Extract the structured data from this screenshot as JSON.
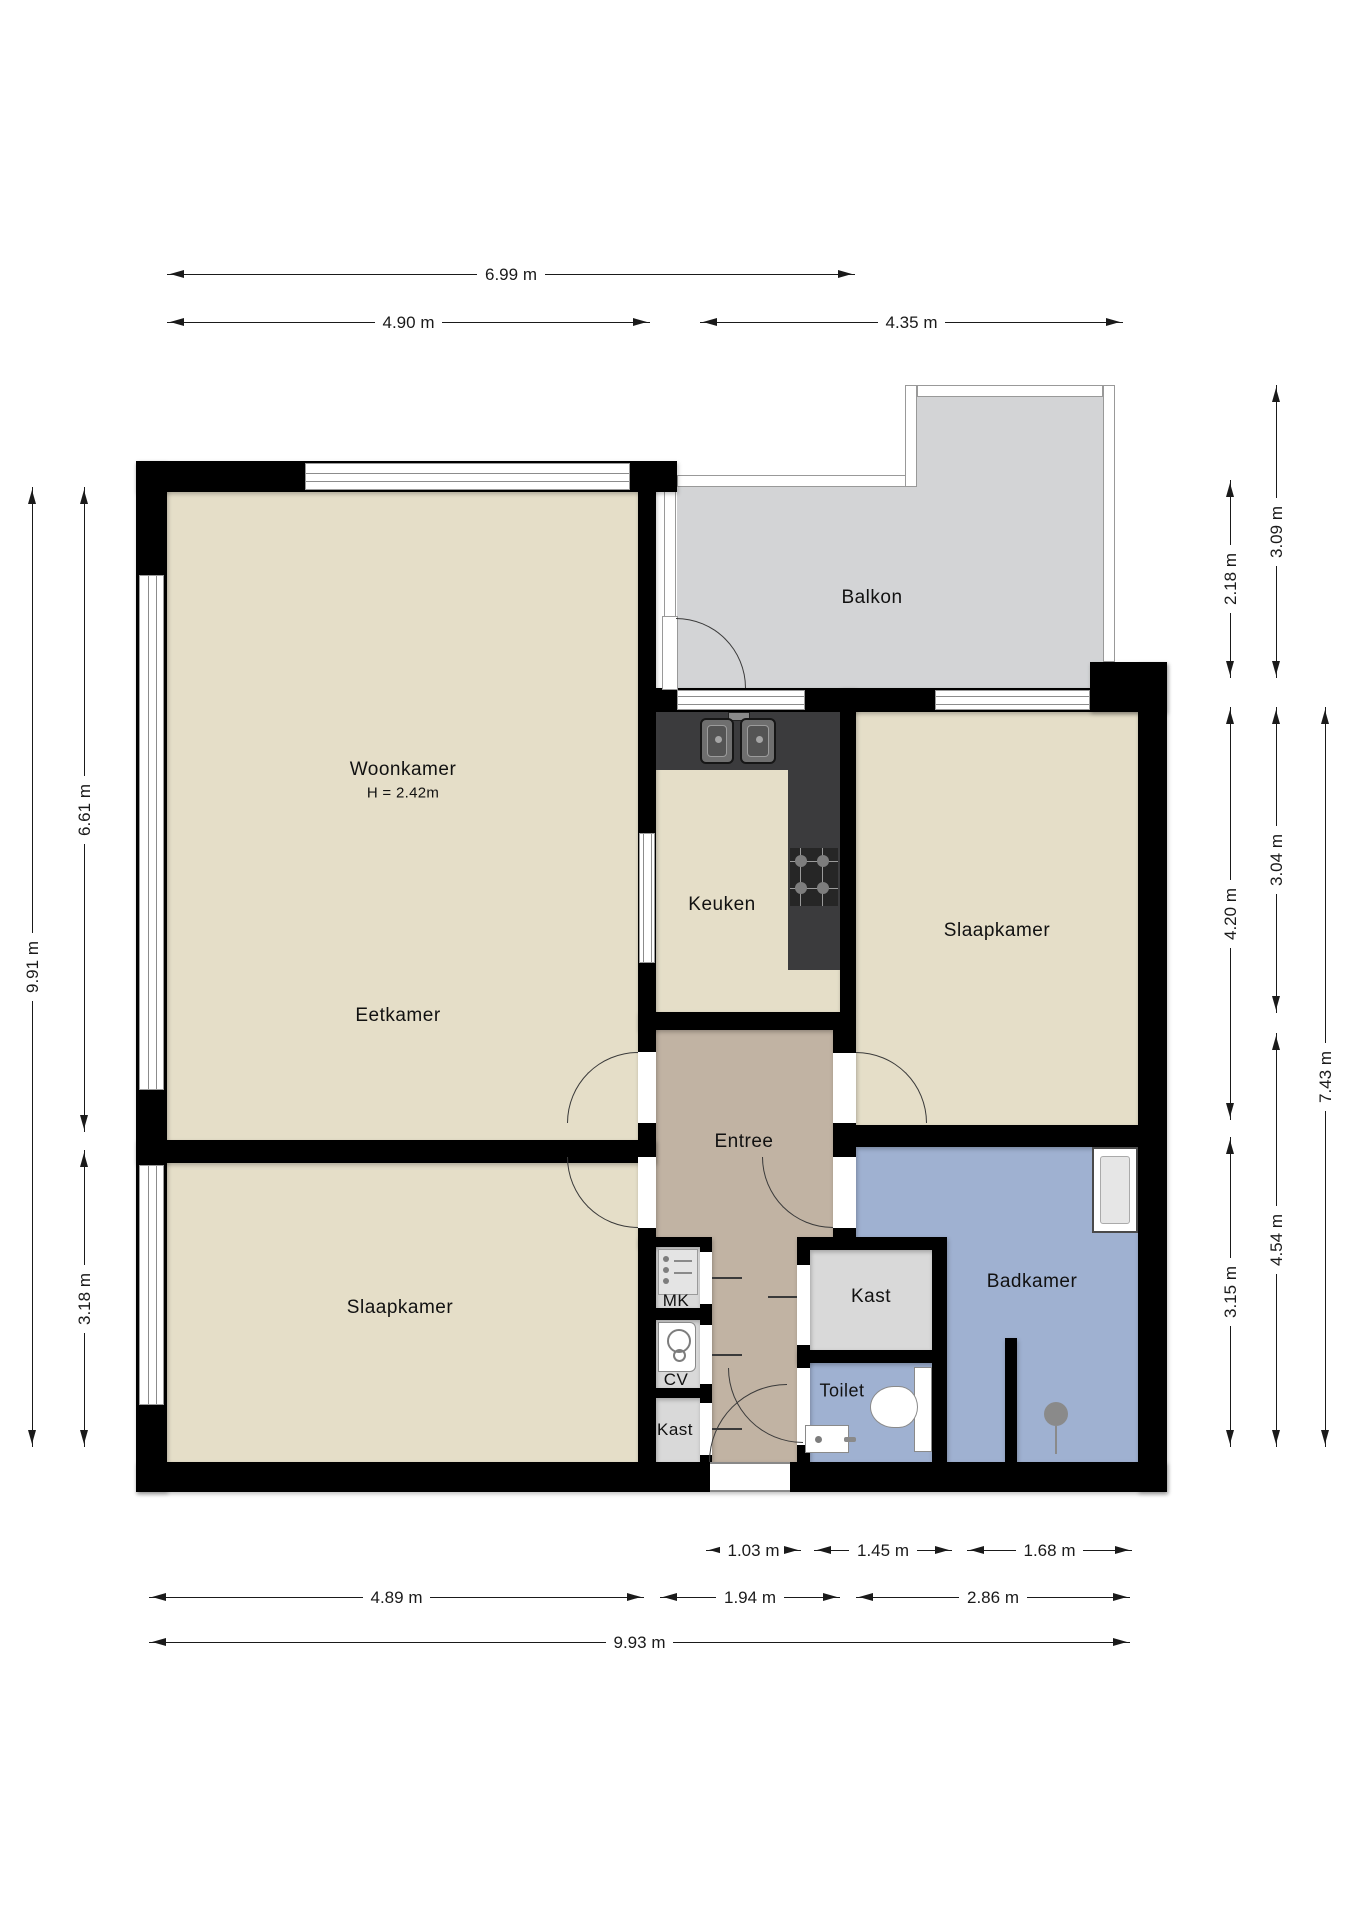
{
  "floorplan": {
    "rooms": {
      "woonkamer": {
        "label": "Woonkamer",
        "ceiling_height": "H = 2.42m"
      },
      "eetkamer": {
        "label": "Eetkamer"
      },
      "keuken": {
        "label": "Keuken"
      },
      "slaapkamer_rechts": {
        "label": "Slaapkamer"
      },
      "slaapkamer_links": {
        "label": "Slaapkamer"
      },
      "entree": {
        "label": "Entree"
      },
      "balkon": {
        "label": "Balkon"
      },
      "badkamer": {
        "label": "Badkamer"
      },
      "toilet": {
        "label": "Toilet"
      },
      "kast_groot": {
        "label": "Kast"
      },
      "kast_klein": {
        "label": "Kast"
      },
      "meterkast": {
        "label": "MK"
      },
      "cv_kast": {
        "label": "CV"
      }
    },
    "dimensions": {
      "top": [
        "6.99 m",
        "4.90 m",
        "4.35 m"
      ],
      "left": [
        "9.91 m",
        "6.61 m",
        "3.18 m"
      ],
      "right": [
        "3.09 m",
        "2.18 m",
        "3.04 m",
        "4.20 m",
        "7.43 m",
        "3.15 m",
        "4.54 m"
      ],
      "bottom": [
        "1.03 m",
        "1.45 m",
        "1.68 m",
        "4.89 m",
        "1.94 m",
        "2.86 m",
        "9.93 m"
      ]
    },
    "colors": {
      "wall": "#000000",
      "room_floor": "#e5dec8",
      "entree_floor": "#c1b3a3",
      "wet_room_floor": "#9fb1d1",
      "closet_floor": "#d9d9d9",
      "balcony_floor": "#d3d4d6",
      "kitchen_counter": "#3b3b3d"
    }
  }
}
